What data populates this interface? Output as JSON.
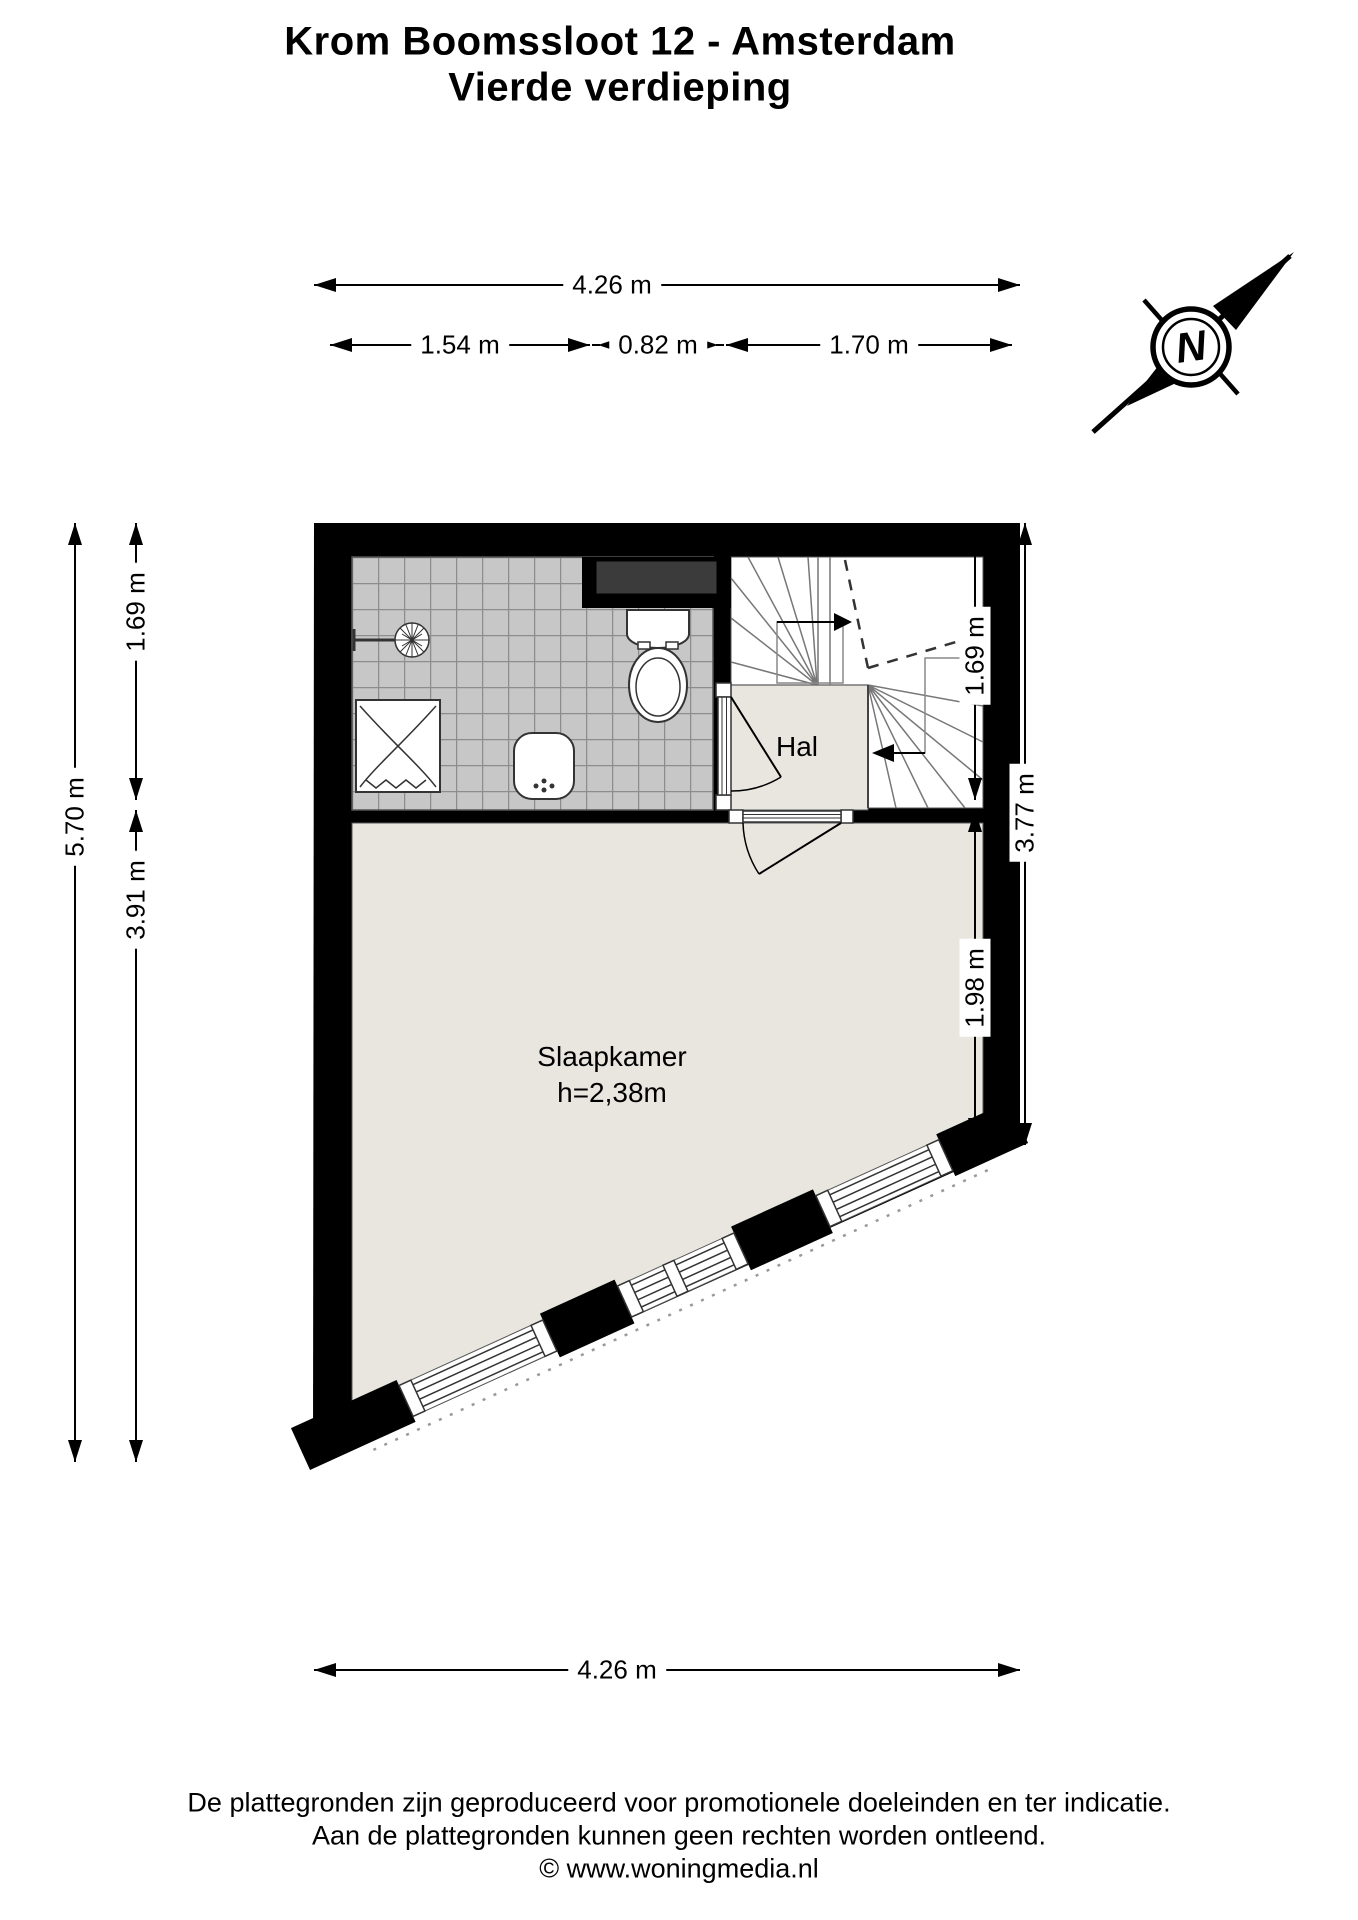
{
  "title": {
    "line1": "Krom Boomssloot 12 - Amsterdam",
    "line2": "Vierde verdieping"
  },
  "plan": {
    "compass": {
      "label": "N"
    },
    "rooms": {
      "hall": {
        "name": "Hal"
      },
      "bedroom": {
        "name": "Slaapkamer",
        "height_note": "h=2,38m"
      }
    },
    "dimensions": {
      "top_total": "4.26 m",
      "top_segments": [
        "1.54 m",
        "0.82 m",
        "1.70 m"
      ],
      "left_outer": "5.70 m",
      "left_inner": [
        "1.69 m",
        "3.91 m"
      ],
      "right_inner": [
        "1.69 m",
        "1.98 m"
      ],
      "right_outer": "3.77 m",
      "bottom_total": "4.26 m"
    },
    "colors": {
      "wall": "#000000",
      "floor": "#e8e6df",
      "tile": "#c7c7c7",
      "tile_grout": "#8d8d8d",
      "shaft": "#3b3b3b",
      "stair_tread": "#777777"
    }
  },
  "footer": {
    "line1": "De plattegronden zijn geproduceerd voor promotionele doeleinden en ter indicatie.",
    "line2": "Aan de plattegronden kunnen geen rechten worden ontleend.",
    "line3": "© www.woningmedia.nl"
  }
}
